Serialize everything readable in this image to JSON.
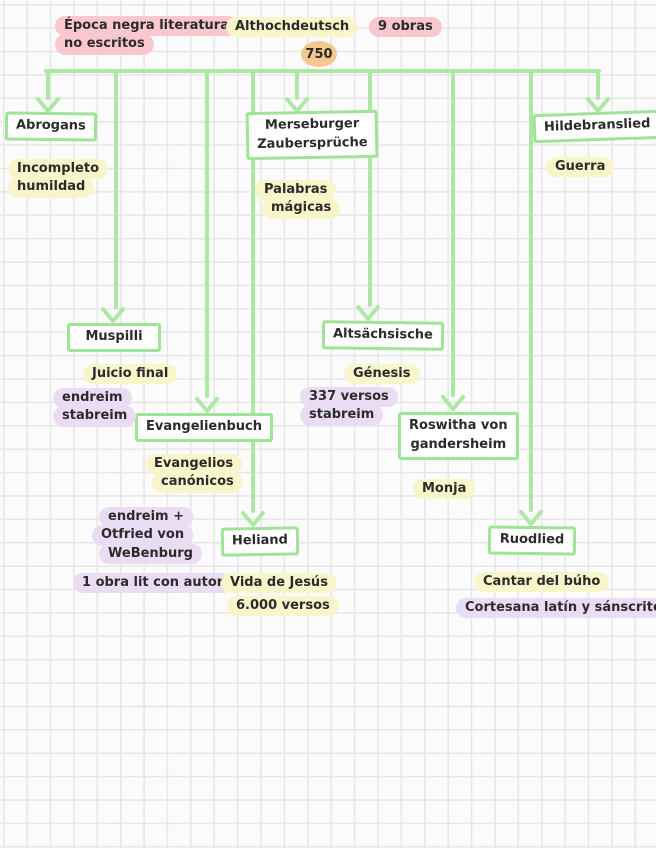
{
  "palette": {
    "connector_green": "#ace8a3",
    "box_border_green": "#9fe396",
    "highlight_pink": "#f8c8ce",
    "highlight_yellow": "#f9f5cb",
    "highlight_purple": "#e9dcf3",
    "year_orange": "#f3c78e",
    "ink": "#2b2b2b"
  },
  "header": {
    "era_note": {
      "lines": [
        "Época negra literatura",
        "no escritos"
      ]
    },
    "root": {
      "label": "Althochdeutsch",
      "year": "750"
    },
    "works_count": "9 obras"
  },
  "nodes": {
    "abrogans": {
      "title": [
        "Abrogans"
      ],
      "notes": [
        {
          "color": "yellow",
          "lines": [
            "Incompleto",
            "humildad"
          ]
        }
      ]
    },
    "merseburger": {
      "title": [
        "Merseburger",
        "Zaubersprüche"
      ],
      "notes": [
        {
          "color": "yellow",
          "lines": [
            "Palabras",
            "mágicas"
          ]
        }
      ]
    },
    "hildebranslied": {
      "title": [
        "Hildebranslied"
      ],
      "notes": [
        {
          "color": "yellow",
          "lines": [
            "Guerra"
          ]
        }
      ]
    },
    "muspilli": {
      "title": [
        "Muspilli"
      ],
      "notes": [
        {
          "color": "yellow",
          "lines": [
            "Juicio final"
          ]
        },
        {
          "color": "purple",
          "lines": [
            "endreim",
            "stabreim"
          ]
        }
      ]
    },
    "evangelienbuch": {
      "title": [
        "Evangelienbuch"
      ],
      "notes": [
        {
          "color": "yellow",
          "lines": [
            "Evangelios",
            "canónicos"
          ]
        },
        {
          "color": "purple",
          "lines": [
            "endreim +",
            "Otfried von",
            "WeBenburg"
          ]
        },
        {
          "color": "purple",
          "lines": [
            "1 obra lit con autor"
          ]
        }
      ]
    },
    "heliand": {
      "title": [
        "Heliand"
      ],
      "notes": [
        {
          "color": "yellow",
          "lines": [
            "Vida de Jesús"
          ]
        },
        {
          "color": "yellow",
          "lines": [
            "6.000 versos"
          ]
        }
      ]
    },
    "altsachsische": {
      "title": [
        "Altsächsische"
      ],
      "notes": [
        {
          "color": "yellow",
          "lines": [
            "Génesis"
          ]
        },
        {
          "color": "purple",
          "lines": [
            "337 versos",
            "stabreim"
          ]
        }
      ]
    },
    "roswitha": {
      "title": [
        "Roswitha von",
        "gandersheim"
      ],
      "notes": [
        {
          "color": "yellow",
          "lines": [
            "Monja"
          ]
        }
      ]
    },
    "ruodlied": {
      "title": [
        "Ruodlied"
      ],
      "notes": [
        {
          "color": "yellow",
          "lines": [
            "Cantar del búho"
          ]
        },
        {
          "color": "purple",
          "lines": [
            "Cortesana latín y sánscrito"
          ]
        }
      ]
    }
  }
}
